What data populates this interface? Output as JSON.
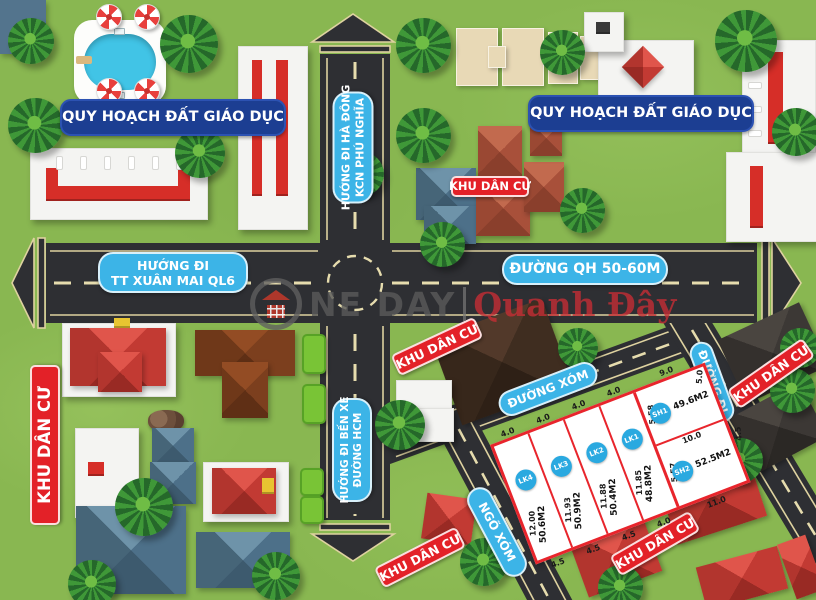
{
  "labels": {
    "education": "QUY HOẠCH ĐẤT GIÁO DỤC",
    "residential": "KHU DÂN CƯ",
    "dir_hadong_1": "HƯỚNG ĐI HÀ ĐÔNG",
    "dir_hadong_2": "KCN PHÚ NGHĨA",
    "dir_xuanmai_1": "HƯỚNG ĐI",
    "dir_xuanmai_2": "TT XUÂN MAI QL6",
    "dir_benxe_1": "HƯỚNG ĐI BẾN XE",
    "dir_benxe_2": "ĐƯỜNG HCM",
    "road_qh": "ĐƯỜNG QH 50-60M",
    "road_xom": "ĐƯỜNG XÓM",
    "alley": "NGÕ XÓM",
    "road_di": "ĐƯỜNG ĐI"
  },
  "watermark": {
    "prefix": "NE DAY",
    "suffix": "Quanh Đây"
  },
  "plots": {
    "lk4": {
      "id": "LK4",
      "area": "50.6M2",
      "top": "4.0",
      "side": "12.00",
      "bottom": "4.5"
    },
    "lk3": {
      "id": "LK3",
      "area": "50.9M2",
      "top": "4.0",
      "side": "11.93",
      "bottom": "4.5"
    },
    "lk2": {
      "id": "LK2",
      "area": "50.4M2",
      "top": "4.0",
      "side": "11.88",
      "bottom": "4.5"
    },
    "lk1": {
      "id": "LK1",
      "area": "48.8M2",
      "top": "4.0",
      "side": "11.85",
      "bottom": "4.0"
    },
    "sh1": {
      "id": "SH1",
      "area": "49.6M2",
      "top": "9.0",
      "left": "5.58",
      "right": "5.0",
      "bottom": "10.0"
    },
    "sh2": {
      "id": "SH2",
      "area": "52.5M2",
      "left": "5.57",
      "right": "4.5",
      "bottom": "11.0"
    }
  },
  "colors": {
    "grass": "#89b751",
    "road": "#2e2f33",
    "road_line": "#ded2a0",
    "label_navy": "#1c3e92",
    "label_sky": "#3cb4e7",
    "label_red": "#e32128",
    "plot_border": "#e8252c",
    "badge_blue": "#2aa9e0"
  }
}
